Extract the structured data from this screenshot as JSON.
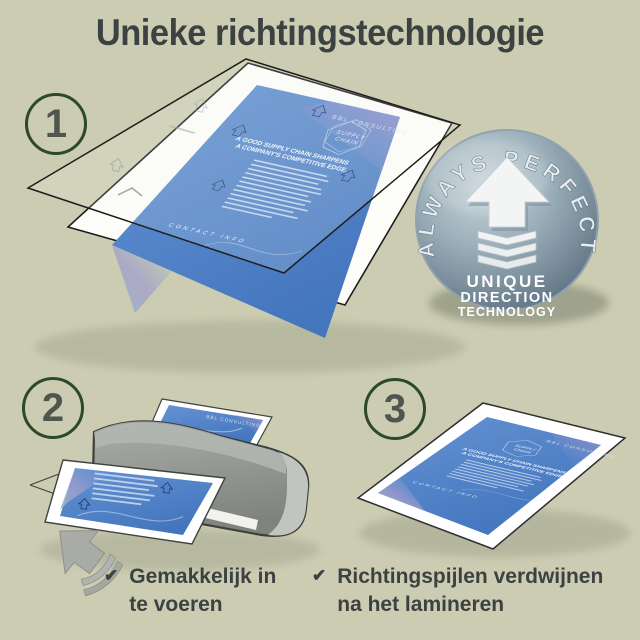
{
  "title": "Unieke richtingstechnologie",
  "steps": [
    {
      "number": "1"
    },
    {
      "number": "2"
    },
    {
      "number": "3"
    }
  ],
  "badge": {
    "arc_text": "ALWAYS PERFECT!",
    "line1": "UNIQUE",
    "line2": "DIRECTION",
    "line3": "TECHNOLOGY"
  },
  "flyer": {
    "brand": "BBL CONSULTING",
    "logo_line1": "SUPPLY",
    "logo_line2": "CHAIN",
    "headline_line1": "A GOOD SUPPLY CHAIN SHARPENS",
    "headline_line2": "A COMPANY'S COMPETITIVE EDGE.",
    "footer": "CONTACT  INFO"
  },
  "captions": [
    {
      "check": "✔",
      "line1": "Gemakkelijk in",
      "line2": "te voeren"
    },
    {
      "check": "✔",
      "line1": "Richtingspijlen verdwijnen",
      "line2": "na het lamineren"
    }
  ],
  "colors": {
    "background": "#cbccb1",
    "heading_text": "#3c4241",
    "step_circle_border": "#2c4a28",
    "step_number": "#50554f",
    "badge_light": "#c9d5da",
    "badge_dark": "#5f7383",
    "badge_text": "#ffffff",
    "flyer_blue": "#5b8ccb",
    "laminator_gray": "#949893"
  }
}
